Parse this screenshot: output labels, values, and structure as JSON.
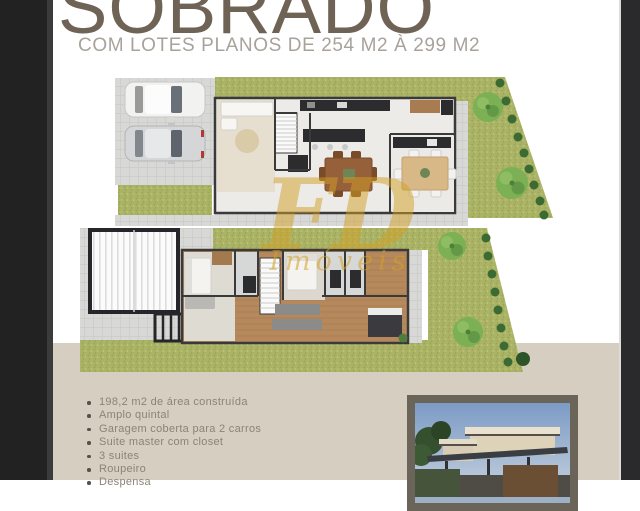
{
  "title": "SOBRADO",
  "subtitle": "COM LOTES PLANOS DE 254 M2 À 299 M2",
  "watermark": {
    "initials": "FD",
    "name": "Imóveis"
  },
  "features": [
    "198,2 m2 de área construída",
    "Amplo quintal",
    "Garagem coberta para 2 carros",
    "Suite master com closet",
    "3 suites",
    "Roupeiro",
    "Despensa"
  ],
  "colors": {
    "side_bar": "#222222",
    "beige_section": "#d6cec0",
    "title": "#6e6355",
    "subtitle": "#a8a29b",
    "feature_text": "#8b8477",
    "watermark_gold": "#d3a125",
    "photo_frame": "#6b6459",
    "grass": "#abb366",
    "pavement": "#d8d8d6"
  }
}
